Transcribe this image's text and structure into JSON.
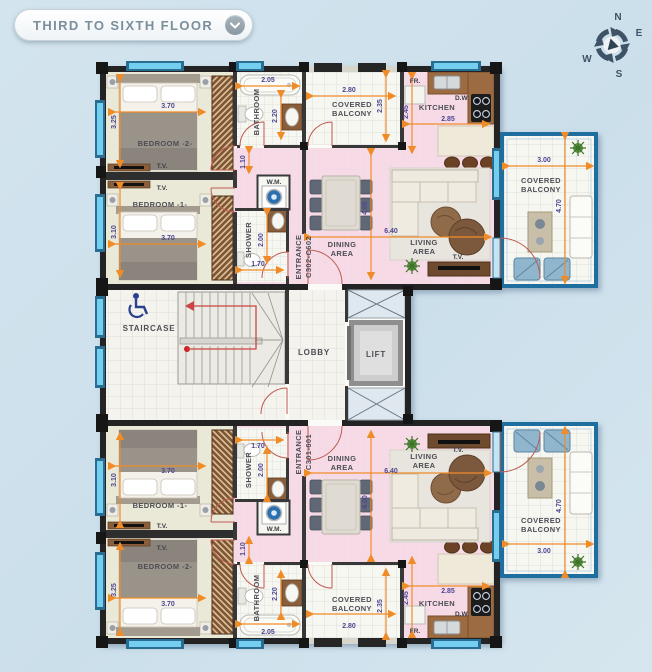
{
  "header": {
    "title": "THIRD TO SIXTH FLOOR"
  },
  "compass": {
    "north": "N",
    "east": "E",
    "south": "S",
    "west": "W"
  },
  "core": {
    "staircase": "STAIRCASE",
    "lobby": "LOBBY",
    "lift": "LIFT"
  },
  "labels": {
    "bedroom1": "BEDROOM -1-",
    "bedroom2": "BEDROOM -2-",
    "bathroom": "BATHROOM",
    "shower": "SHOWER",
    "kitchen": "KITCHEN",
    "dining_l1": "DINING",
    "dining_l2": "AREA",
    "living_l1": "LIVING",
    "living_l2": "AREA",
    "covered_l1": "COVERED",
    "covered_l2": "BALCONY",
    "tv": "T.V.",
    "wm": "W.M.",
    "fridge": "FR.",
    "dishwasher": "D.W.",
    "entrance": "ENTRANCE"
  },
  "apartments": {
    "upper": {
      "entrance_code": "C302-C602"
    },
    "lower": {
      "entrance_code": "C301-601"
    }
  },
  "dimensions": {
    "bedroom_w": "3.70",
    "bedroom2_h": "3.25",
    "bedroom1_h": "3.10",
    "bathroom_w": "2.05",
    "bathroom_h": "2.20",
    "balcony_mid_w": "2.80",
    "balcony_mid_h": "2.35",
    "kitchen_h": "2.45",
    "kitchen_w": "2.85",
    "hall_w": "1.10",
    "shower_h": "2.00",
    "shower_w": "1.70",
    "living_w": "6.40",
    "living_h": "4.00",
    "balcony_right_w": "3.00",
    "balcony_right_h": "4.70"
  },
  "colors": {
    "background": "#cfe1ec",
    "wall": "#232323",
    "pink_area": "#f6dbe7",
    "bedroom_beige": "#eae8d6",
    "window_blue": "#74cef0",
    "railing_blue": "#1e6f9f",
    "dimension_orange": "#f08c28",
    "dimension_text": "#4e4691",
    "door_arc_red": "#bf5a50",
    "stair_arrow_red": "#cc4444",
    "wheelchair_navy": "#2b3f8f"
  }
}
